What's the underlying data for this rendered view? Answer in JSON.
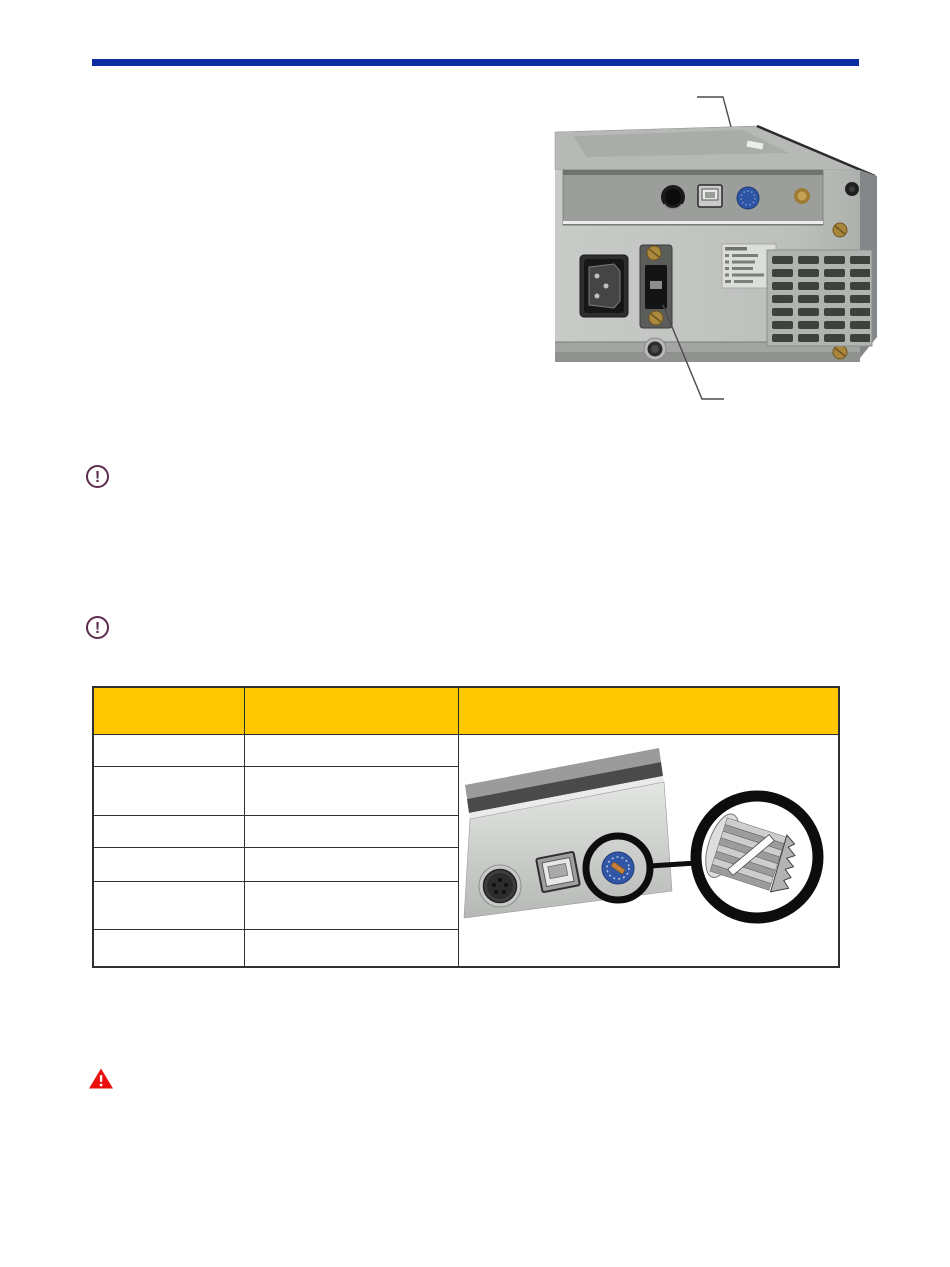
{
  "document": {
    "type": "hardware-manual-page",
    "background": "#ffffff"
  },
  "header": {
    "rule_color": "#0b2da1"
  },
  "figure_rear_panel": {
    "name": "device-rear-panel-photo",
    "features": [
      "din-connector",
      "usb-b-port",
      "blue-rotary-switch",
      "power-inlet",
      "serial-connector",
      "settings-label",
      "vent-grille"
    ],
    "label_rows": 6,
    "callouts": 2
  },
  "note_icons": [
    {
      "glyph": "!",
      "color": "#5d2b4e"
    },
    {
      "glyph": "!",
      "color": "#5d2b4e"
    }
  ],
  "warning_icon": {
    "glyph": "!",
    "color": "#e9100e"
  },
  "table": {
    "header_bg": "#ffc800",
    "border_color": "#2f2f2f",
    "columns": [
      "",
      "",
      ""
    ],
    "rows": [
      [
        "",
        ""
      ],
      [
        "",
        ""
      ],
      [
        "",
        ""
      ],
      [
        "",
        ""
      ],
      [
        "",
        ""
      ],
      [
        "",
        ""
      ]
    ]
  },
  "figure_switch_detail": {
    "name": "rotary-switch-magnified-view",
    "dial_color": "#3156a6"
  }
}
